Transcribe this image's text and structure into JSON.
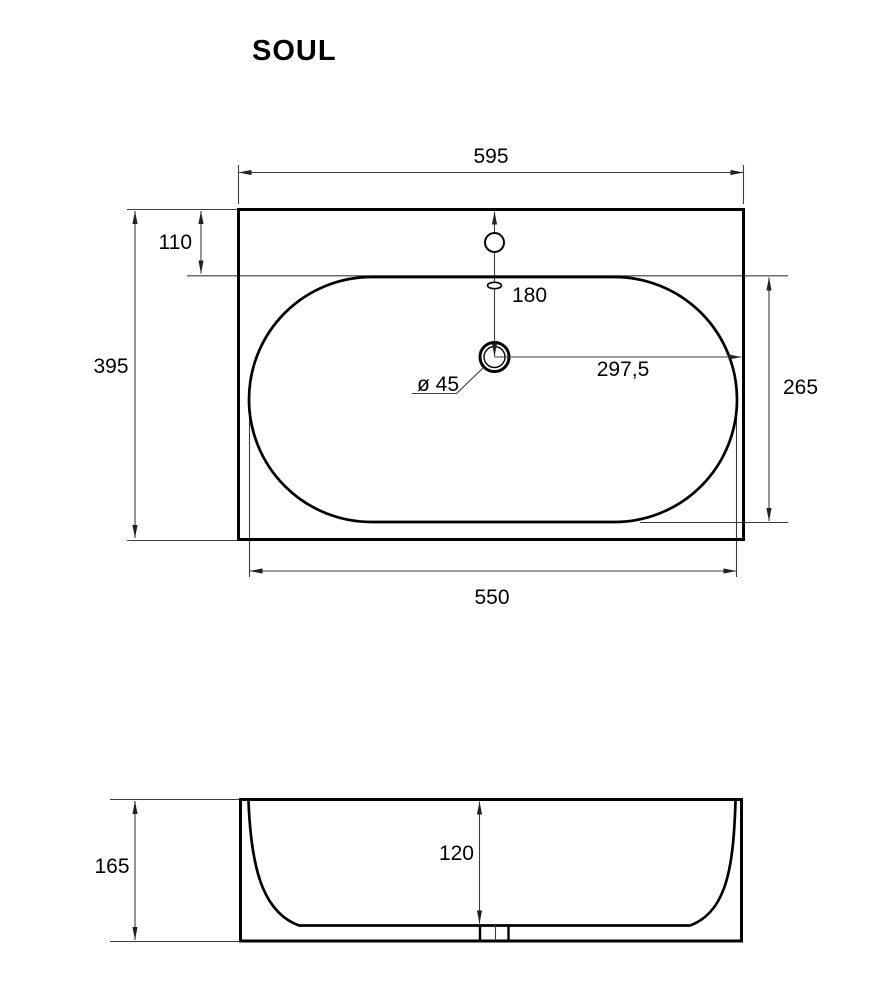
{
  "title": "SOUL",
  "top_view": {
    "overall_width": "595",
    "tap_hole_offset": "110",
    "overall_depth": "395",
    "bowl_width": "550",
    "tap_to_drain": "180",
    "drain_diameter": "ø 45",
    "drain_to_right_edge": "297,5",
    "bowl_depth": "265"
  },
  "side_view": {
    "bowl_inner_depth": "120",
    "overall_height": "165"
  },
  "colors": {
    "outline": "#000000",
    "dimension_lines": "#3c3c3c",
    "background": "#ffffff"
  }
}
